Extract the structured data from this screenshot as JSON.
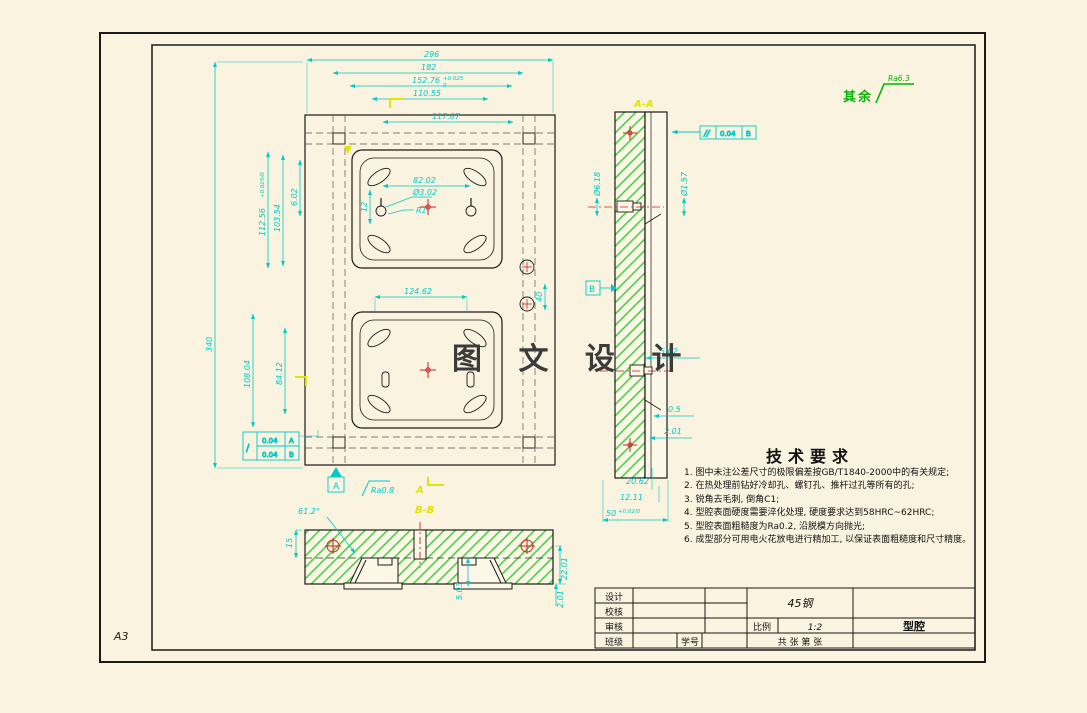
{
  "sheet": {
    "size_label": "A3",
    "watermark": "图 文 设 计",
    "rest_note_prefix": "其余",
    "rest_note_value": "Ra6.3"
  },
  "tech_requirements": {
    "title": "技术要求",
    "items": [
      "1. 图中未注公差尺寸的极限偏差按GB/T1840-2000中的有关规定;",
      "2. 在热处理前钻好冷却孔、螺钉孔、推杆过孔等所有的孔;",
      "3. 锐角去毛刺, 倒角C1;",
      "4. 型腔表面硬度需要淬化处理, 硬度要求达到58HRC~62HRC;",
      "5. 型腔表面粗糙度为Ra0.2, 沿脱模方向抛光;",
      "6. 成型部分可用电火花放电进行精加工, 以保证表面粗糙度和尺寸精度。"
    ]
  },
  "title_block": {
    "design_label": "设计",
    "check_label": "校核",
    "review_label": "审核",
    "class_label": "班级",
    "student_id_label": "学号",
    "material": "45钢",
    "scale_label": "比例",
    "scale_value": "1:2",
    "sheets_label": "共    张  第    张",
    "part_name": "型腔"
  },
  "labels": {
    "section_a": "A-A",
    "section_b": "B-B",
    "datum_a": "A",
    "datum_b": "B",
    "cut_a": "A"
  },
  "tolerances": {
    "fcf_parallel": {
      "symbol": "//",
      "value": "0.04",
      "datum": "B"
    },
    "fcf_combined": {
      "symbol": "/",
      "row1_value": "0.04",
      "row1_datum": "A",
      "row2_value": "0.04",
      "row2_datum": "B"
    }
  },
  "dims": {
    "top_w1": "296",
    "top_w2": "182",
    "top_w3": "152.76",
    "top_w3_tol_up": "+0.025",
    "top_w3_tol_dn": "0",
    "top_w4": "110.55",
    "inner_w": "117.87",
    "left_h": "340",
    "cav_h": "112.56",
    "cav_h_tol": "+0.025/0",
    "cav_h2": "103.54",
    "hole_off": "6.02",
    "cav2_h": "108.04",
    "cav2_h2": "84.12",
    "hole_span": "82.02",
    "hole_dia": "Ø3.02",
    "fillet": "R1",
    "small_v": "12",
    "cav2_w": "124.62",
    "bush_span": "40",
    "sec_dia1": "Ø6.18",
    "sec_dia2": "Ø1.57",
    "sec_d1": "5.02",
    "sec_d2": "0.5",
    "sec_d3": "2.01",
    "sec_b1": "20.62",
    "sec_b2": "12.11",
    "bot_w": "50",
    "bot_w_tol": "+0.02/0",
    "bb_angle": "61.2°",
    "bb_h": "15",
    "bb_d1": "5.03",
    "bb_d2": "22.01",
    "bb_d3": "2.01",
    "rough_a": "Ra0.8"
  },
  "colors": {
    "dimension": "#00c9c9",
    "hatch": "#33cc33",
    "highlight": "#e3e300",
    "centerline": "#cc2222",
    "note_green": "#00b400",
    "paper": "#faf3df"
  }
}
